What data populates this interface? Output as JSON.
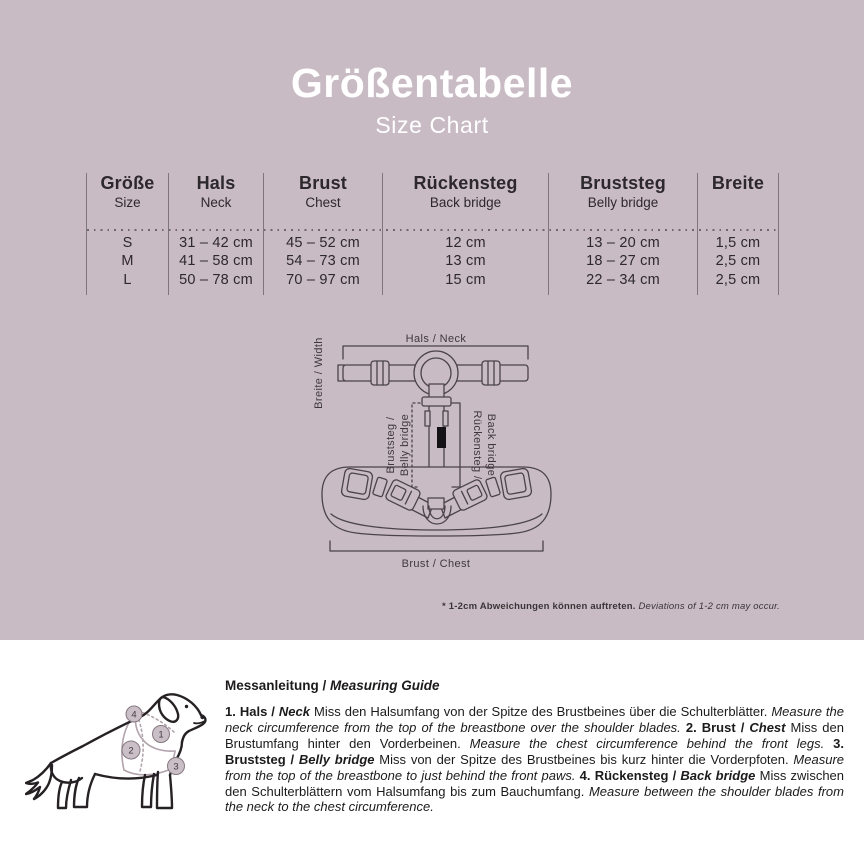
{
  "page": {
    "background_color": "#c9bbc3",
    "text_color": "#2c282b",
    "title_color": "#ffffff"
  },
  "header": {
    "title": "Größentabelle",
    "subtitle": "Size Chart"
  },
  "size_table": {
    "columns": [
      {
        "de": "Größe",
        "en": "Size"
      },
      {
        "de": "Hals",
        "en": "Neck"
      },
      {
        "de": "Brust",
        "en": "Chest"
      },
      {
        "de": "Rückensteg",
        "en": "Back bridge"
      },
      {
        "de": "Bruststeg",
        "en": "Belly bridge"
      },
      {
        "de": "Breite",
        "en": ""
      }
    ],
    "rows": [
      [
        "S",
        "31 – 42 cm",
        "45 – 52 cm",
        "12 cm",
        "13 – 20 cm",
        "1,5 cm"
      ],
      [
        "M",
        "41 – 58 cm",
        "54 – 73 cm",
        "13 cm",
        "18 – 27 cm",
        "2,5 cm"
      ],
      [
        "L",
        "50 – 78 cm",
        "70 – 97 cm",
        "15 cm",
        "22 – 34 cm",
        "2,5 cm"
      ]
    ]
  },
  "diagram": {
    "labels": {
      "neck": "Hals / Neck",
      "width": "Breite / Width",
      "belly_bridge_line1": "Bruststeg /",
      "belly_bridge_line2": "Belly bridge",
      "back_bridge_line1": "Rückensteg /",
      "back_bridge_line2": "Back bridge",
      "chest": "Brust / Chest"
    }
  },
  "footnote": {
    "segments": [
      {
        "t": "* 1-2cm Abweichungen können auftreten. ",
        "b": true
      },
      {
        "t": "Deviations of 1-2 cm may occur.",
        "i": true
      }
    ]
  },
  "dog": {
    "markers": [
      "1",
      "2",
      "3",
      "4"
    ]
  },
  "measuring_guide": {
    "heading_segments": [
      {
        "t": "Messanleitung / ",
        "b": true
      },
      {
        "t": "Measuring Guide",
        "b": true,
        "i": true
      }
    ],
    "body_segments": [
      {
        "t": "1. Hals / ",
        "b": true
      },
      {
        "t": "Neck",
        "b": true,
        "i": true
      },
      {
        "t": " Miss den Halsumfang von der Spitze des Brustbeines über die Schulterblätter. "
      },
      {
        "t": "Measure the neck circumference from the top of the breastbone over the shoulder blades. ",
        "i": true
      },
      {
        "t": "2. Brust / ",
        "b": true
      },
      {
        "t": "Chest",
        "b": true,
        "i": true
      },
      {
        "t": " Miss den Brustumfang hinter den Vorderbeinen. "
      },
      {
        "t": "Measure the chest circumference behind the front legs. ",
        "i": true
      },
      {
        "t": "3. Bruststeg / ",
        "b": true
      },
      {
        "t": "Belly bridge",
        "b": true,
        "i": true
      },
      {
        "t": " Miss von der Spitze des Brustbeines bis kurz hinter die Vorderpfoten. "
      },
      {
        "t": "Measure from the top of the breastbone to just behind the front paws. ",
        "i": true
      },
      {
        "t": "4. Rückensteg / ",
        "b": true
      },
      {
        "t": "Back bridge",
        "b": true,
        "i": true
      },
      {
        "t": " Miss zwischen den Schulterblättern vom Halsumfang bis zum Bauchumfang. "
      },
      {
        "t": "Measure between the shoulder blades from the neck to the chest circumference.",
        "i": true
      }
    ]
  }
}
